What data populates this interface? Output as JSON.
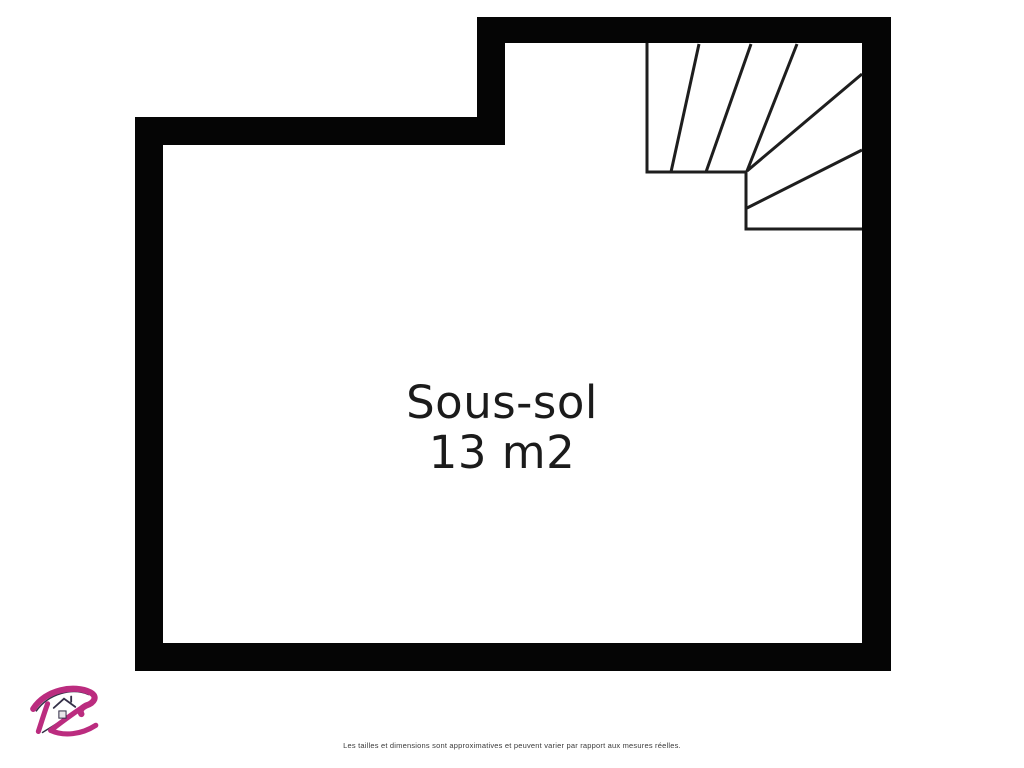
{
  "floorplan": {
    "room": {
      "name": "Sous-sol",
      "area": "13 m2"
    },
    "disclaimer": "Les tailles et dimensions sont approximatives et peuvent varier par rapport aux mesures réelles."
  },
  "icons": {
    "logo": "agency-logo-r-icon"
  },
  "colors": {
    "background": "#ffffff",
    "wall": "#050505",
    "stair_line": "#1e1e1e",
    "room_text": "#1b1b1b",
    "disclaimer_text": "#3a3a3a",
    "logo_magenta": "#bb2c7f",
    "logo_dark": "#343048"
  }
}
